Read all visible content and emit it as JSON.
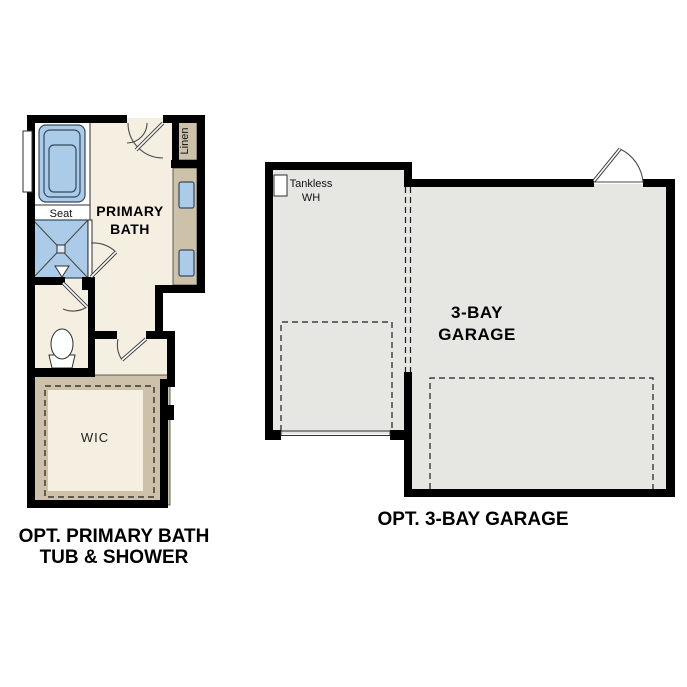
{
  "plans": {
    "bath": {
      "caption": {
        "line1": "OPT. PRIMARY BATH",
        "line2": "TUB & SHOWER"
      },
      "room_label": {
        "line1": "PRIMARY",
        "line2": "BATH"
      },
      "seat_label": "Seat",
      "linen_label": "Linen",
      "wic_label": "WIC"
    },
    "garage": {
      "caption": "OPT. 3-BAY GARAGE",
      "room_label": {
        "line1": "3-BAY",
        "line2": "GARAGE"
      },
      "tankless_label": {
        "line1": "Tankless",
        "line2": "WH"
      }
    }
  },
  "colors": {
    "wall": "#000000",
    "bath_floor": "#f5efe1",
    "garage_floor": "#e6e6e3",
    "cabinet_tan": "#cdc2a9",
    "fixture_blue": "#abcbe9",
    "fixture_white": "#ffffff"
  }
}
